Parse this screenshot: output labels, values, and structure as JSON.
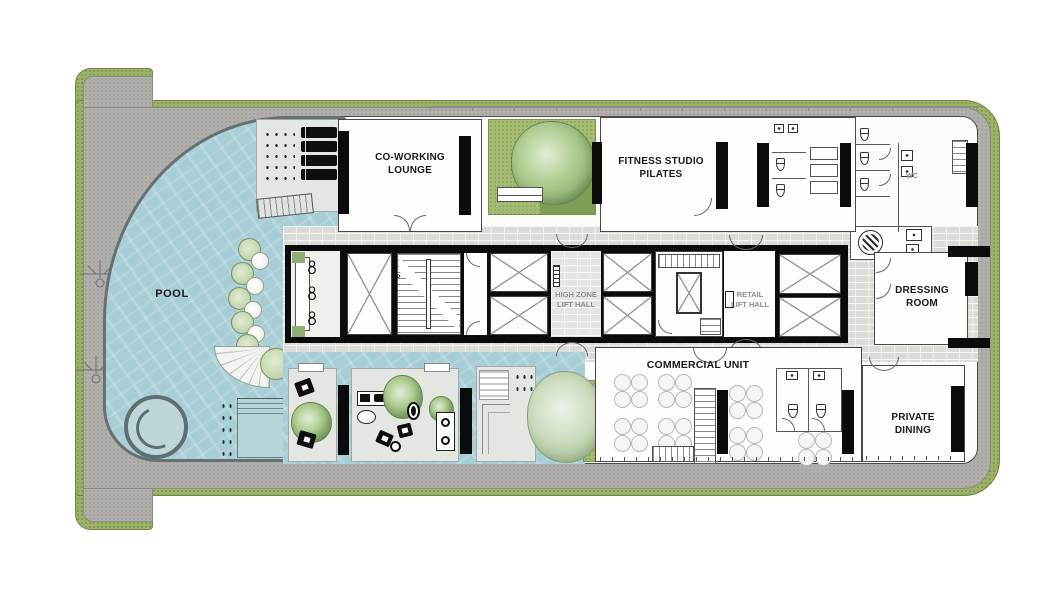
{
  "plan_title": "Amenity Floor Plan",
  "labels": {
    "pool": "POOL",
    "coworking": "CO-WORKING\nLOUNGE",
    "fitness": "FITNESS STUDIO\nPILATES",
    "high_zone": "HIGH ZONE\nLIFT HALL",
    "retail": "RETAIL\nLIFT HALL",
    "commercial": "COMMERCIAL UNIT",
    "dressing": "DRESSING\nROOM",
    "private_dining": "PRIVATE\nDINING",
    "wc": "WC",
    "up": "UP"
  },
  "colors": {
    "landscape_border": "#9db266",
    "deck_paving": "#b0afac",
    "pool_water": "#a8ced5",
    "corridor_tile": "#dbdbd8",
    "core_wall": "#0b0b0b",
    "room_fill": "#fefefe",
    "garden_grass": "#a5bc72",
    "tree_canopy": "#94b677",
    "label_dark": "#1a1a1a",
    "label_gray": "#8d8d8d"
  },
  "icons": {
    "tree": "circular-canopy",
    "shrub": "small-circle",
    "sun-lounger": "black-rounded-rect",
    "spa": "double-ring",
    "lift-shaft": "rect-with-x",
    "stair": "tread-lines",
    "dining-table": "four-circle-cluster",
    "toilet": "tank-and-bowl",
    "sink": "square-with-dot",
    "fan": "circle-with-blades",
    "person": "double-ring-glyph",
    "door": "quarter-arc",
    "survey-marker": "line-circle-ticks"
  }
}
